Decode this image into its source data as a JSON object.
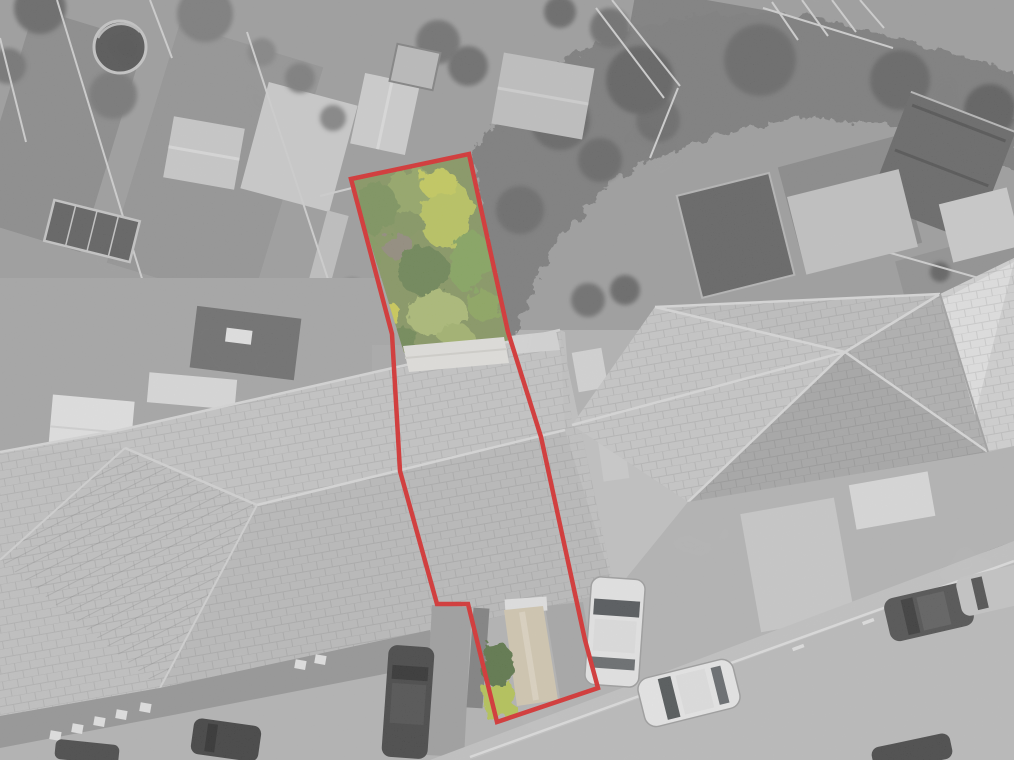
{
  "scene": {
    "kind": "aerial-drone-photograph",
    "highlight": "property plot outlined in red, plot garden shown in colour against greyscale surroundings",
    "visible_text": "none"
  },
  "palette": {
    "boundary_red": "#de1313",
    "base_gray": "#b2b2b2",
    "roof_gray": "#c6c6c6",
    "hedge_gray": "#6f6f6f",
    "road_gray": "#bcbcbc"
  },
  "boundary": {
    "points": "351,179 469,154 508,332 541,437 585,640 598,688 497,722 468,604 437,604 400,471 392,334",
    "stroke_width": "4.5"
  },
  "garden": {
    "base_fill": "#7e9150",
    "clip_points": "351,179 469,154 508,334 510,348 404,353",
    "bushes": [
      {
        "cx": 420,
        "cy": 196,
        "rx": 34,
        "ry": 26,
        "rot": 15,
        "fill": "#8fa556"
      },
      {
        "cx": 447,
        "cy": 215,
        "rx": 26,
        "ry": 34,
        "rot": 10,
        "fill": "#bac84e"
      },
      {
        "cx": 438,
        "cy": 183,
        "rx": 20,
        "ry": 14,
        "rot": 0,
        "fill": "#c9cf49"
      },
      {
        "cx": 376,
        "cy": 208,
        "rx": 22,
        "ry": 26,
        "rot": 0,
        "fill": "#6f8c49"
      },
      {
        "cx": 408,
        "cy": 225,
        "rx": 16,
        "ry": 14,
        "rot": 0,
        "fill": "#7a9150"
      },
      {
        "cx": 398,
        "cy": 246,
        "rx": 15,
        "ry": 13,
        "rot": 0,
        "fill": "#8b8270"
      },
      {
        "cx": 424,
        "cy": 272,
        "rx": 26,
        "ry": 24,
        "rot": 0,
        "fill": "#5e7b40"
      },
      {
        "cx": 470,
        "cy": 262,
        "rx": 20,
        "ry": 30,
        "rot": 8,
        "fill": "#7ca24e"
      },
      {
        "cx": 484,
        "cy": 305,
        "rx": 17,
        "ry": 15,
        "rot": 0,
        "fill": "#85a34e"
      },
      {
        "cx": 437,
        "cy": 314,
        "rx": 30,
        "ry": 22,
        "rot": -8,
        "fill": "#a9bd67"
      },
      {
        "cx": 385,
        "cy": 312,
        "rx": 14,
        "ry": 12,
        "rot": 0,
        "fill": "#d2d13f"
      },
      {
        "cx": 370,
        "cy": 297,
        "rx": 11,
        "ry": 10,
        "rot": 0,
        "fill": "#c6cc48"
      },
      {
        "cx": 368,
        "cy": 255,
        "rx": 10,
        "ry": 18,
        "rot": 8,
        "fill": "#78934e"
      },
      {
        "cx": 407,
        "cy": 338,
        "rx": 12,
        "ry": 9,
        "rot": 0,
        "fill": "#62803f"
      },
      {
        "cx": 455,
        "cy": 335,
        "rx": 18,
        "ry": 10,
        "rot": 0,
        "fill": "#9fb35f"
      }
    ]
  },
  "plot_front": {
    "garage_roof_white": "#ebebeb",
    "path_tan": "#d8ccb0",
    "path_tan_light": "#e7dcc4",
    "hedge_green": "#4a6831",
    "grass_green": "#b5c843",
    "drive_gray": "#a4a4a4"
  },
  "grays": {
    "trees": [
      {
        "cx": 40,
        "cy": 8,
        "r": 26,
        "fill": "#585858"
      },
      {
        "cx": 8,
        "cy": 66,
        "r": 18,
        "fill": "#666666"
      },
      {
        "cx": 113,
        "cy": 95,
        "r": 24,
        "fill": "#6a6a6a"
      },
      {
        "cx": 205,
        "cy": 14,
        "r": 28,
        "fill": "#6f6f6f"
      },
      {
        "cx": 262,
        "cy": 52,
        "r": 14,
        "fill": "#7a7a7a"
      },
      {
        "cx": 300,
        "cy": 78,
        "r": 15,
        "fill": "#717171"
      },
      {
        "cx": 333,
        "cy": 118,
        "r": 13,
        "fill": "#7a7a7a"
      },
      {
        "cx": 438,
        "cy": 42,
        "r": 22,
        "fill": "#646464"
      },
      {
        "cx": 468,
        "cy": 66,
        "r": 20,
        "fill": "#5d5d5d"
      },
      {
        "cx": 560,
        "cy": 12,
        "r": 16,
        "fill": "#585858"
      },
      {
        "cx": 610,
        "cy": 28,
        "r": 20,
        "fill": "#606060"
      },
      {
        "cx": 658,
        "cy": 120,
        "r": 22,
        "fill": "#5a5a5a"
      },
      {
        "cx": 560,
        "cy": 120,
        "r": 30,
        "fill": "#555555"
      },
      {
        "cx": 640,
        "cy": 80,
        "r": 34,
        "fill": "#4f4f4f"
      },
      {
        "cx": 760,
        "cy": 60,
        "r": 36,
        "fill": "#585858"
      },
      {
        "cx": 900,
        "cy": 80,
        "r": 30,
        "fill": "#525252"
      },
      {
        "cx": 990,
        "cy": 110,
        "r": 26,
        "fill": "#4c4c4c"
      },
      {
        "cx": 520,
        "cy": 210,
        "r": 24,
        "fill": "#5a5a5a"
      },
      {
        "cx": 600,
        "cy": 160,
        "r": 22,
        "fill": "#565656"
      },
      {
        "cx": 352,
        "cy": 292,
        "r": 14,
        "fill": "#6e6e6e"
      },
      {
        "cx": 0,
        "cy": 335,
        "r": 20,
        "fill": "#646464"
      },
      {
        "cx": 28,
        "cy": 392,
        "r": 16,
        "fill": "#6b6b6b"
      },
      {
        "cx": 588,
        "cy": 300,
        "r": 17,
        "fill": "#5e5e5e"
      },
      {
        "cx": 625,
        "cy": 290,
        "r": 15,
        "fill": "#575757"
      },
      {
        "cx": 940,
        "cy": 272,
        "r": 10,
        "fill": "#4f4f4f"
      },
      {
        "cx": 668,
        "cy": 600,
        "r": 12,
        "fill": "#4e4e4e"
      },
      {
        "cx": 690,
        "cy": 615,
        "r": 13,
        "fill": "#474747"
      },
      {
        "cx": 712,
        "cy": 600,
        "r": 11,
        "fill": "#525252"
      },
      {
        "cx": 722,
        "cy": 635,
        "r": 10,
        "fill": "#4a4a4a"
      },
      {
        "cx": 700,
        "cy": 645,
        "r": 9,
        "fill": "#555555"
      },
      {
        "cx": 965,
        "cy": 520,
        "r": 16,
        "fill": "#4d4d4d"
      },
      {
        "cx": 992,
        "cy": 540,
        "r": 14,
        "fill": "#555555"
      },
      {
        "cx": 940,
        "cy": 560,
        "r": 9,
        "fill": "#5a5a5a"
      },
      {
        "cx": 458,
        "cy": 686,
        "r": 24,
        "fill": "#4f4f4f"
      },
      {
        "cx": 432,
        "cy": 660,
        "r": 14,
        "fill": "#5d5d5d"
      },
      {
        "cx": 205,
        "cy": 700,
        "r": 10,
        "fill": "#565656"
      },
      {
        "cx": 235,
        "cy": 690,
        "r": 8,
        "fill": "#5e5e5e"
      }
    ],
    "fences": [
      [
        57,
        0,
        135,
        256
      ],
      [
        135,
        256,
        158,
        330
      ],
      [
        0,
        38,
        26,
        142
      ],
      [
        247,
        32,
        342,
        322
      ],
      [
        150,
        0,
        172,
        58
      ],
      [
        320,
        196,
        352,
        188
      ],
      [
        612,
        0,
        680,
        86
      ],
      [
        596,
        8,
        664,
        98
      ],
      [
        678,
        88,
        650,
        158
      ],
      [
        880,
        250,
        1014,
        288
      ],
      [
        763,
        8,
        893,
        48
      ],
      [
        772,
        2,
        798,
        40
      ],
      [
        802,
        0,
        828,
        36
      ],
      [
        832,
        0,
        856,
        32
      ],
      [
        860,
        0,
        884,
        28
      ]
    ]
  },
  "vehicles": {
    "driveway_white": "#f0f0f0",
    "road_white": "#f3f3f3",
    "road_dark": "#3a3a3a",
    "road_gray_partial": "#c9c9c9",
    "drive_dark": "#2d2d2d",
    "parked_black_a": "#262626",
    "parked_black_b": "#303030",
    "road_dark_partial": "#2e2e2e"
  },
  "road": {
    "dash_fill": "#e9e9e9",
    "dashes": [
      [
        652,
        700
      ],
      [
        722,
        674
      ],
      [
        792,
        648
      ],
      [
        862,
        622
      ],
      [
        932,
        596
      ]
    ]
  }
}
